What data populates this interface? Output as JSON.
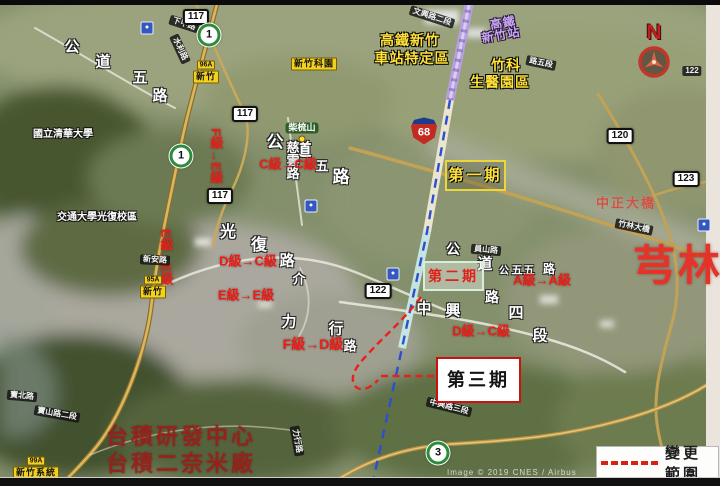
{
  "page": {
    "credit": "Image © 2019 CNES / Airbus"
  },
  "compass": {
    "letter": "N"
  },
  "legend": {
    "title": "變更範圍",
    "dash_color": "#d81f14"
  },
  "map": {
    "phases": [
      {
        "name": "phase-1-box",
        "label": "第一期",
        "x": 445,
        "y": 160,
        "w": 57,
        "h": 27,
        "border": "#edd53c",
        "bg": "rgba(45,45,10,0.22)",
        "color": "#ffe23c",
        "size": 15
      },
      {
        "name": "phase-2-box",
        "label": "第二期",
        "x": 423,
        "y": 261,
        "w": 57,
        "h": 26,
        "border": "#d8eed8",
        "bg": "rgba(250,255,250,0.38)",
        "color": "#e0211a",
        "size": 14
      },
      {
        "name": "phase-3-box",
        "label": "第三期",
        "x": 436,
        "y": 357,
        "w": 81,
        "h": 42,
        "border": "#cc1111",
        "bg": "#ffffff",
        "color": "#141414",
        "size": 18
      }
    ],
    "grade_labels": [
      {
        "text": "F級→E級",
        "x": 216,
        "y": 156,
        "vertical": true,
        "size": 13
      },
      {
        "text": "E級→E級",
        "x": 166,
        "y": 257,
        "vertical": true,
        "size": 13
      },
      {
        "text": "C級→C級",
        "x": 288,
        "y": 164,
        "size": 13
      },
      {
        "text": "D級→C級",
        "x": 248,
        "y": 261,
        "size": 13
      },
      {
        "text": "E級→E級",
        "x": 246,
        "y": 295,
        "size": 13
      },
      {
        "text": "F級→D級",
        "x": 313,
        "y": 344,
        "size": 14
      },
      {
        "text": "A級→A級",
        "x": 542,
        "y": 280,
        "size": 13
      },
      {
        "text": "D級→C級",
        "x": 481,
        "y": 331,
        "size": 13
      }
    ],
    "area_texts": [
      {
        "text": "高鐵新竹",
        "x": 410,
        "y": 40,
        "cls": "t-yellow",
        "size": 14
      },
      {
        "text": "車站特定區",
        "x": 412,
        "y": 58,
        "cls": "t-yellow",
        "size": 14
      },
      {
        "text": "竹科",
        "x": 506,
        "y": 65,
        "cls": "t-yellow",
        "size": 14
      },
      {
        "text": "生醫園區",
        "x": 500,
        "y": 82,
        "cls": "t-yellow",
        "size": 14
      },
      {
        "text": "高鐵",
        "x": 503,
        "y": 23,
        "cls": "t-purple",
        "size": 12,
        "rot": -10
      },
      {
        "text": "新竹站",
        "x": 501,
        "y": 35,
        "cls": "t-purple",
        "size": 12,
        "rot": -10
      },
      {
        "text": "芎林",
        "x": 678,
        "y": 266,
        "cls": "t-bigred",
        "size": 42
      },
      {
        "text": "中正大橋",
        "x": 626,
        "y": 203,
        "cls": "t-fadered",
        "size": 13
      },
      {
        "text": "台積研發中心",
        "x": 181,
        "y": 437,
        "cls": "t-tsmc",
        "size": 22
      },
      {
        "text": "台積二奈米廠",
        "x": 181,
        "y": 464,
        "cls": "t-tsmc",
        "size": 22
      }
    ],
    "poi_labels": [
      {
        "text": "國立清華大學",
        "x": 63,
        "y": 135,
        "size": 10
      },
      {
        "text": "交通大學光復校區",
        "x": 97,
        "y": 218,
        "size": 10
      },
      {
        "text": "柴梳山",
        "x": 302,
        "y": 128,
        "size": 9,
        "pill": true
      }
    ],
    "road_chars": [
      {
        "text": "公",
        "x": 72,
        "y": 47,
        "size": 15
      },
      {
        "text": "道",
        "x": 103,
        "y": 62,
        "size": 15
      },
      {
        "text": "五",
        "x": 140,
        "y": 78,
        "size": 15
      },
      {
        "text": "路",
        "x": 160,
        "y": 96,
        "size": 15
      },
      {
        "text": "公",
        "x": 275,
        "y": 142,
        "size": 17
      },
      {
        "text": "道",
        "x": 303,
        "y": 150,
        "size": 17
      },
      {
        "text": "五",
        "x": 322,
        "y": 166,
        "size": 13
      },
      {
        "text": "路",
        "x": 341,
        "y": 177,
        "size": 17
      },
      {
        "text": "慈雲路",
        "x": 292,
        "y": 160,
        "size": 13,
        "vertical": true
      },
      {
        "text": "光",
        "x": 228,
        "y": 233,
        "size": 16
      },
      {
        "text": "復",
        "x": 259,
        "y": 246,
        "size": 16
      },
      {
        "text": "路",
        "x": 287,
        "y": 261,
        "size": 15
      },
      {
        "text": "介",
        "x": 299,
        "y": 279,
        "size": 13
      },
      {
        "text": "力",
        "x": 289,
        "y": 322,
        "size": 15
      },
      {
        "text": "行",
        "x": 336,
        "y": 329,
        "size": 15
      },
      {
        "text": "路",
        "x": 350,
        "y": 346,
        "size": 13
      },
      {
        "text": "中",
        "x": 424,
        "y": 309,
        "size": 15
      },
      {
        "text": "興",
        "x": 453,
        "y": 311,
        "size": 15
      },
      {
        "text": "路",
        "x": 492,
        "y": 297,
        "size": 14
      },
      {
        "text": "四",
        "x": 516,
        "y": 313,
        "size": 15
      },
      {
        "text": "段",
        "x": 540,
        "y": 336,
        "size": 15
      },
      {
        "text": "公",
        "x": 453,
        "y": 249,
        "size": 14
      },
      {
        "text": "道",
        "x": 485,
        "y": 264,
        "size": 15
      },
      {
        "text": "公",
        "x": 504,
        "y": 272,
        "size": 10
      },
      {
        "text": "五",
        "x": 517,
        "y": 271,
        "size": 11
      },
      {
        "text": "五",
        "x": 529,
        "y": 271,
        "size": 11
      },
      {
        "text": "路",
        "x": 549,
        "y": 269,
        "size": 12
      }
    ],
    "road_badges": [
      {
        "text": "文興路二段",
        "x": 432,
        "y": 17,
        "rot": 18
      },
      {
        "text": "下甲路",
        "x": 184,
        "y": 24,
        "rot": 18
      },
      {
        "text": "水利路",
        "x": 180,
        "y": 49,
        "rot": 65
      },
      {
        "text": "路五段",
        "x": 541,
        "y": 63,
        "rot": 12
      },
      {
        "text": "新安路",
        "x": 155,
        "y": 260,
        "rot": 3
      },
      {
        "text": "員山路",
        "x": 486,
        "y": 250,
        "rot": 5
      },
      {
        "text": "竹林大橋",
        "x": 634,
        "y": 227,
        "rot": 12
      },
      {
        "text": "寶北路",
        "x": 22,
        "y": 396,
        "rot": 5
      },
      {
        "text": "寶山路二段",
        "x": 57,
        "y": 414,
        "rot": 10
      },
      {
        "text": "中興路三段",
        "x": 449,
        "y": 407,
        "rot": 14
      },
      {
        "text": "力行路",
        "x": 297,
        "y": 441,
        "rot": 80
      },
      {
        "text": "122",
        "x": 692,
        "y": 71,
        "rot": 0
      }
    ],
    "yellow_badges": [
      {
        "top": "96A",
        "main": "新竹",
        "x": 206,
        "y": 72
      },
      {
        "top": "95A",
        "main": "新竹",
        "x": 153,
        "y": 287
      },
      {
        "top": "99A",
        "main": "新竹系統",
        "x": 36,
        "y": 468
      },
      {
        "main": "新竹科園",
        "x": 314,
        "y": 64
      }
    ],
    "shields": [
      {
        "kind": "county",
        "text": "117",
        "x": 196,
        "y": 17
      },
      {
        "kind": "county",
        "text": "117",
        "x": 245,
        "y": 114
      },
      {
        "kind": "county",
        "text": "117",
        "x": 220,
        "y": 196
      },
      {
        "kind": "county",
        "text": "122",
        "x": 378,
        "y": 291
      },
      {
        "kind": "county",
        "text": "120",
        "x": 620,
        "y": 136
      },
      {
        "kind": "county",
        "text": "123",
        "x": 686,
        "y": 179
      },
      {
        "kind": "provincial",
        "text": "1",
        "x": 209,
        "y": 35
      },
      {
        "kind": "provincial",
        "text": "1",
        "x": 181,
        "y": 156
      },
      {
        "kind": "provincial",
        "text": "3",
        "x": 438,
        "y": 453
      },
      {
        "kind": "expressway",
        "text": "68",
        "x": 424,
        "y": 131
      }
    ],
    "icons": [
      {
        "kind": "interchange",
        "x": 147,
        "y": 28
      },
      {
        "kind": "interchange",
        "x": 311,
        "y": 206
      },
      {
        "kind": "interchange",
        "x": 393,
        "y": 274
      },
      {
        "kind": "interchange",
        "x": 704,
        "y": 225
      },
      {
        "kind": "poi-dot",
        "x": 302,
        "y": 139
      }
    ]
  }
}
